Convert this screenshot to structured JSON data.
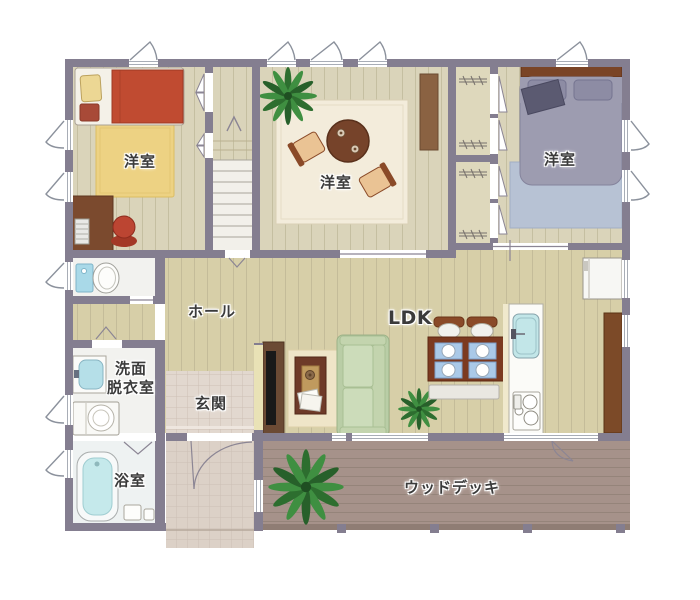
{
  "rooms": {
    "bedroom_west": {
      "label": "洋室"
    },
    "bedroom_center": {
      "label": "洋室"
    },
    "bedroom_east": {
      "label": "洋室"
    },
    "hall": {
      "label": "ホール"
    },
    "ldk": {
      "label": "LDK"
    },
    "entrance": {
      "label": "玄関"
    },
    "washroom": {
      "line1": "洗面",
      "line2": "脱衣室"
    },
    "bathroom": {
      "label": "浴室"
    },
    "wood_deck": {
      "label": "ウッドデッキ"
    }
  },
  "colors": {
    "wall": "#847e90",
    "room_floor": "#dad4ba",
    "hall_floor": "#d7cfa8",
    "closet_floor": "#ded8bc",
    "entrance_tile": "#e2d8cf",
    "porch_tile": "#dcd1c7",
    "deck_wood": "#a6928a",
    "wet_room_floor": "#f2f2ef",
    "bed_red": "#c04b31",
    "rug_yellow": "#edd283",
    "bed_gray": "#9d9cb0",
    "rug_blue": "#b7c2d4",
    "rug_cream": "#f3ecdb",
    "sofa_green": "#c9d8b4",
    "round_table_brown": "#76432a",
    "dining_table_brown": "#7c3a20",
    "placemat_blue": "#aac9e8",
    "water_blue": "#c2e6e8",
    "plant_green": "#2f7a36",
    "cabinet_brown": "#7c4a28",
    "tv_accent_wall": "#e9e2b6",
    "label_text": "#3b3b3b"
  }
}
